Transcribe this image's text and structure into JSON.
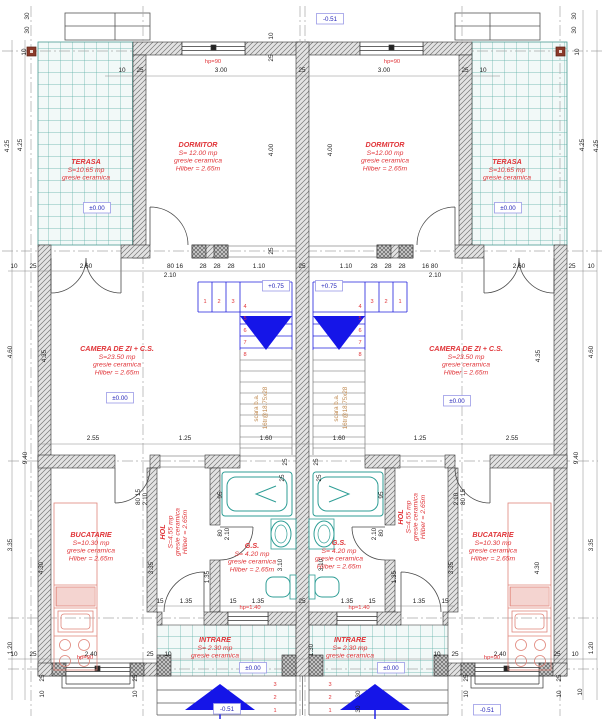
{
  "drawing": {
    "type": "architectural-floor-plan",
    "colors": {
      "room_label": "#e03438",
      "level_text": "#2626b8",
      "level_box_border": "#9a9ae6",
      "stair_blue": "#2020dd",
      "arrow_blue": "#1515e8",
      "tile_teal": "#58ada5",
      "fixture_teal": "#2f9e96",
      "stair_note_orange": "#c08a50",
      "kitchen_pink": "#e0857a",
      "wall_gray": "#6f6f6f",
      "axis_marker_red": "#8b3a2a"
    },
    "rooms": [
      {
        "id": "terasa-left",
        "name": "TERASA",
        "area": "S=10.65 mp",
        "finish": "gresie ceramica",
        "x": 86,
        "y": 164,
        "vertical": false
      },
      {
        "id": "terasa-right",
        "name": "TERASA",
        "area": "S=10.65 mp",
        "finish": "gresie ceramica",
        "x": 507,
        "y": 164,
        "vertical": false
      },
      {
        "id": "dormitor-left",
        "name": "DORMITOR",
        "area": "S= 12.00 mp",
        "finish": "gresie ceramica",
        "height": "Hliber = 2.65m",
        "x": 198,
        "y": 147,
        "vertical": false
      },
      {
        "id": "dormitor-right",
        "name": "DORMITOR",
        "area": "S=12.00 mp",
        "finish": "gresie ceramica",
        "height": "Hliber = 2.65m",
        "x": 385,
        "y": 147,
        "vertical": false
      },
      {
        "id": "camera-zi-left",
        "name": "CAMERA DE ZI + C.S.",
        "area": "S=23.50 mp",
        "finish": "gresie ceramica",
        "height": "Hliber = 2.65m",
        "x": 117,
        "y": 351,
        "vertical": false
      },
      {
        "id": "camera-zi-right",
        "name": "CAMERA DE ZI + C.S.",
        "area": "S=23.50 mp",
        "finish": "gresie ceramica",
        "height": "Hliber = 2.65m",
        "x": 466,
        "y": 351,
        "vertical": false
      },
      {
        "id": "bucatarie-left",
        "name": "BUCATARIE",
        "area": "S=10.30 mp",
        "finish": "gresie ceramica",
        "height": "Hliber = 2.65m",
        "x": 91,
        "y": 537,
        "vertical": false
      },
      {
        "id": "bucatarie-right",
        "name": "BUCATARIE",
        "area": "S=10.30 mp",
        "finish": "gresie ceramica",
        "height": "Hliber = 2.65m",
        "x": 493,
        "y": 537,
        "vertical": false
      },
      {
        "id": "hol-left",
        "name": "HOL",
        "area": "S=4.55 mp",
        "finish": "gresie ceramica",
        "height": "Hliber = 2.65m",
        "x": 176,
        "y": 532,
        "vertical": true
      },
      {
        "id": "hol-right",
        "name": "HOL",
        "area": "S=4.55 mp",
        "finish": "gresie ceramica",
        "height": "Hliber = 2.65m",
        "x": 414,
        "y": 517,
        "vertical": true
      },
      {
        "id": "gs-left",
        "name": "G.S.",
        "area": "S= 4.20 mp",
        "finish": "gresie ceramica",
        "height": "Hliber = 2.65m",
        "x": 252,
        "y": 548,
        "vertical": false
      },
      {
        "id": "gs-right",
        "name": "G.S.",
        "area": "S= 4.20 mp",
        "finish": "gresie ceramica",
        "height": "Hliber = 2.65m",
        "x": 339,
        "y": 545,
        "vertical": false
      },
      {
        "id": "intrare-left",
        "name": "INTRARE",
        "area": "S= 2.30 mp",
        "finish": "gresie ceramica",
        "x": 215,
        "y": 642,
        "vertical": false
      },
      {
        "id": "intrare-right",
        "name": "INTRARE",
        "area": "S= 2.30 mp",
        "finish": "gresie ceramica",
        "x": 350,
        "y": 642,
        "vertical": false
      }
    ],
    "levels": [
      {
        "t": "-0.51",
        "x": 330,
        "y": 21
      },
      {
        "t": "±0.00",
        "x": 97,
        "y": 210
      },
      {
        "t": "±0.00",
        "x": 508,
        "y": 210
      },
      {
        "t": "+0.75",
        "x": 276,
        "y": 288
      },
      {
        "t": "+0.75",
        "x": 329,
        "y": 288
      },
      {
        "t": "±0.00",
        "x": 120,
        "y": 400
      },
      {
        "t": "±0.00",
        "x": 457,
        "y": 403
      },
      {
        "t": "±0.00",
        "x": 253,
        "y": 670
      },
      {
        "t": "±0.00",
        "x": 391,
        "y": 670
      },
      {
        "t": "-0.51",
        "x": 227,
        "y": 711
      },
      {
        "t": "-0.51",
        "x": 487,
        "y": 712
      }
    ],
    "hp_labels": [
      {
        "t": "hp=90",
        "x": 213,
        "y": 63
      },
      {
        "t": "hp=90",
        "x": 392,
        "y": 63
      },
      {
        "t": "hp=90",
        "x": 85,
        "y": 659
      },
      {
        "t": "hp=90",
        "x": 492,
        "y": 659
      },
      {
        "t": "hp=1.40",
        "x": 250,
        "y": 609
      },
      {
        "t": "hp=1.40",
        "x": 359,
        "y": 609
      }
    ],
    "stair_notes": [
      {
        "lines": [
          "scara b.a.",
          "16tr@18.75x28"
        ],
        "x": 258,
        "y": 408
      },
      {
        "lines": [
          "scara b.a.",
          "16tr@18.75x28"
        ],
        "x": 338,
        "y": 408
      }
    ],
    "step_numbers": [
      {
        "t": "1",
        "x": 205,
        "y": 303
      },
      {
        "t": "2",
        "x": 219,
        "y": 303
      },
      {
        "t": "3",
        "x": 233,
        "y": 303
      },
      {
        "t": "4",
        "x": 245,
        "y": 308
      },
      {
        "t": "5",
        "x": 245,
        "y": 320
      },
      {
        "t": "6",
        "x": 245,
        "y": 332
      },
      {
        "t": "7",
        "x": 245,
        "y": 344
      },
      {
        "t": "8",
        "x": 245,
        "y": 356
      },
      {
        "t": "1",
        "x": 400,
        "y": 303
      },
      {
        "t": "2",
        "x": 386,
        "y": 303
      },
      {
        "t": "3",
        "x": 372,
        "y": 303
      },
      {
        "t": "4",
        "x": 360,
        "y": 308
      },
      {
        "t": "5",
        "x": 360,
        "y": 320
      },
      {
        "t": "6",
        "x": 360,
        "y": 332
      },
      {
        "t": "7",
        "x": 360,
        "y": 344
      },
      {
        "t": "8",
        "x": 360,
        "y": 356
      },
      {
        "t": "3",
        "x": 275,
        "y": 686
      },
      {
        "t": "2",
        "x": 275,
        "y": 699
      },
      {
        "t": "1",
        "x": 275,
        "y": 712
      },
      {
        "t": "3",
        "x": 330,
        "y": 686
      },
      {
        "t": "2",
        "x": 330,
        "y": 699
      },
      {
        "t": "1",
        "x": 330,
        "y": 712
      }
    ],
    "dims": [
      {
        "t": "10",
        "x": 122,
        "y": 72
      },
      {
        "t": "25",
        "x": 140,
        "y": 72
      },
      {
        "t": "3.00",
        "x": 221,
        "y": 72
      },
      {
        "t": "25",
        "x": 302,
        "y": 72
      },
      {
        "t": "3.00",
        "x": 384,
        "y": 72
      },
      {
        "t": "25",
        "x": 465,
        "y": 72
      },
      {
        "t": "10",
        "x": 483,
        "y": 72
      },
      {
        "t": "10",
        "x": 273,
        "y": 36,
        "v": 1
      },
      {
        "t": "25",
        "x": 273,
        "y": 58,
        "v": 1
      },
      {
        "t": "10",
        "x": 14,
        "y": 268
      },
      {
        "t": "25",
        "x": 33,
        "y": 268
      },
      {
        "t": "2.60",
        "x": 86,
        "y": 268
      },
      {
        "t": "80 16",
        "x": 175,
        "y": 268
      },
      {
        "t": "28",
        "x": 203,
        "y": 268
      },
      {
        "t": "28",
        "x": 217,
        "y": 268
      },
      {
        "t": "28",
        "x": 231,
        "y": 268
      },
      {
        "t": "1.10",
        "x": 259,
        "y": 268
      },
      {
        "t": "25",
        "x": 302,
        "y": 268
      },
      {
        "t": "1.10",
        "x": 346,
        "y": 268
      },
      {
        "t": "28",
        "x": 374,
        "y": 268
      },
      {
        "t": "28",
        "x": 388,
        "y": 268
      },
      {
        "t": "28",
        "x": 402,
        "y": 268
      },
      {
        "t": "16 80",
        "x": 430,
        "y": 268
      },
      {
        "t": "2.60",
        "x": 519,
        "y": 268
      },
      {
        "t": "25",
        "x": 572,
        "y": 268
      },
      {
        "t": "10",
        "x": 591,
        "y": 268
      },
      {
        "t": "2.10",
        "x": 170,
        "y": 277
      },
      {
        "t": "2.10",
        "x": 435,
        "y": 277
      },
      {
        "t": "2.55",
        "x": 93,
        "y": 440
      },
      {
        "t": "1.25",
        "x": 185,
        "y": 440
      },
      {
        "t": "1.60",
        "x": 266,
        "y": 440
      },
      {
        "t": "1.60",
        "x": 339,
        "y": 440
      },
      {
        "t": "1.25",
        "x": 420,
        "y": 440
      },
      {
        "t": "2.55",
        "x": 512,
        "y": 440
      },
      {
        "t": "25",
        "x": 287,
        "y": 462,
        "v": 1
      },
      {
        "t": "25",
        "x": 318,
        "y": 462,
        "v": 1
      },
      {
        "t": "95",
        "x": 222,
        "y": 495,
        "v": 1
      },
      {
        "t": "80",
        "x": 222,
        "y": 533,
        "v": 1
      },
      {
        "t": "2.10",
        "x": 229,
        "y": 534,
        "v": 1
      },
      {
        "t": "3.10",
        "x": 282,
        "y": 565,
        "v": 1
      },
      {
        "t": "1.35",
        "x": 209,
        "y": 577,
        "v": 1
      },
      {
        "t": "95",
        "x": 383,
        "y": 495,
        "v": 1
      },
      {
        "t": "80",
        "x": 383,
        "y": 533,
        "v": 1
      },
      {
        "t": "2.10",
        "x": 376,
        "y": 534,
        "v": 1
      },
      {
        "t": "3.10",
        "x": 323,
        "y": 565,
        "v": 1
      },
      {
        "t": "1.35",
        "x": 396,
        "y": 577,
        "v": 1
      },
      {
        "t": "80 15",
        "x": 140,
        "y": 497,
        "v": 1
      },
      {
        "t": "2.10",
        "x": 147,
        "y": 499,
        "v": 1
      },
      {
        "t": "3.35",
        "x": 153,
        "y": 568,
        "v": 1
      },
      {
        "t": "80 15",
        "x": 465,
        "y": 497,
        "v": 1
      },
      {
        "t": "2.10",
        "x": 458,
        "y": 499,
        "v": 1
      },
      {
        "t": "3.35",
        "x": 453,
        "y": 568,
        "v": 1
      },
      {
        "t": "4.30",
        "x": 43,
        "y": 568,
        "v": 1
      },
      {
        "t": "4.30",
        "x": 539,
        "y": 568,
        "v": 1
      },
      {
        "t": "15",
        "x": 160,
        "y": 603
      },
      {
        "t": "1.35",
        "x": 186,
        "y": 603
      },
      {
        "t": "15",
        "x": 233,
        "y": 603
      },
      {
        "t": "1.35",
        "x": 258,
        "y": 603
      },
      {
        "t": "25",
        "x": 302,
        "y": 603
      },
      {
        "t": "1.35",
        "x": 347,
        "y": 603
      },
      {
        "t": "15",
        "x": 372,
        "y": 603
      },
      {
        "t": "1.35",
        "x": 419,
        "y": 603
      },
      {
        "t": "15",
        "x": 445,
        "y": 603
      },
      {
        "t": "25",
        "x": 284,
        "y": 478,
        "v": 1
      },
      {
        "t": "25",
        "x": 321,
        "y": 478,
        "v": 1
      },
      {
        "t": "1.30",
        "x": 313,
        "y": 650,
        "v": 1
      },
      {
        "t": "30",
        "x": 360,
        "y": 694,
        "v": 1
      },
      {
        "t": "30",
        "x": 360,
        "y": 709,
        "v": 1
      },
      {
        "t": "10",
        "x": 14,
        "y": 656
      },
      {
        "t": "25",
        "x": 33,
        "y": 656
      },
      {
        "t": "2.40",
        "x": 91,
        "y": 656
      },
      {
        "t": "25",
        "x": 150,
        "y": 656
      },
      {
        "t": "10",
        "x": 168,
        "y": 656
      },
      {
        "t": "10",
        "x": 437,
        "y": 656
      },
      {
        "t": "25",
        "x": 455,
        "y": 656
      },
      {
        "t": "2.40",
        "x": 500,
        "y": 656
      },
      {
        "t": "25",
        "x": 557,
        "y": 656
      },
      {
        "t": "10",
        "x": 575,
        "y": 656
      },
      {
        "t": "25",
        "x": 44,
        "y": 678,
        "v": 1
      },
      {
        "t": "10",
        "x": 44,
        "y": 694,
        "v": 1
      },
      {
        "t": "25",
        "x": 137,
        "y": 678,
        "v": 1
      },
      {
        "t": "10",
        "x": 137,
        "y": 694,
        "v": 1
      },
      {
        "t": "25",
        "x": 468,
        "y": 678,
        "v": 1
      },
      {
        "t": "10",
        "x": 468,
        "y": 694,
        "v": 1
      },
      {
        "t": "25",
        "x": 561,
        "y": 678,
        "v": 1
      },
      {
        "t": "10",
        "x": 561,
        "y": 694,
        "v": 1
      },
      {
        "t": "30",
        "x": 29,
        "y": 16,
        "v": 1
      },
      {
        "t": "30",
        "x": 29,
        "y": 30,
        "v": 1
      },
      {
        "t": "10",
        "x": 26,
        "y": 52,
        "v": 1
      },
      {
        "t": "4.25",
        "x": 9,
        "y": 146,
        "v": 1
      },
      {
        "t": "4.25",
        "x": 22,
        "y": 145,
        "v": 1
      },
      {
        "t": "30",
        "x": 576,
        "y": 16,
        "v": 1
      },
      {
        "t": "30",
        "x": 576,
        "y": 30,
        "v": 1
      },
      {
        "t": "10",
        "x": 579,
        "y": 52,
        "v": 1
      },
      {
        "t": "4.25",
        "x": 584,
        "y": 145,
        "v": 1
      },
      {
        "t": "4.25",
        "x": 598,
        "y": 146,
        "v": 1
      },
      {
        "t": "4.60",
        "x": 593,
        "y": 352,
        "v": 1
      },
      {
        "t": "9.40",
        "x": 578,
        "y": 458,
        "v": 1
      },
      {
        "t": "3.35",
        "x": 593,
        "y": 545,
        "v": 1
      },
      {
        "t": "1.20",
        "x": 593,
        "y": 648,
        "v": 1
      },
      {
        "t": "10",
        "x": 582,
        "y": 692,
        "v": 1
      },
      {
        "t": "4.60",
        "x": 12,
        "y": 352,
        "v": 1
      },
      {
        "t": "9.40",
        "x": 27,
        "y": 458,
        "v": 1
      },
      {
        "t": "3.35",
        "x": 12,
        "y": 545,
        "v": 1
      },
      {
        "t": "1.20",
        "x": 12,
        "y": 648,
        "v": 1
      },
      {
        "t": "4.00",
        "x": 273,
        "y": 150,
        "v": 1
      },
      {
        "t": "4.00",
        "x": 332,
        "y": 150,
        "v": 1
      },
      {
        "t": "4.35",
        "x": 46,
        "y": 356,
        "v": 1
      },
      {
        "t": "4.35",
        "x": 540,
        "y": 356,
        "v": 1
      },
      {
        "t": "25",
        "x": 273,
        "y": 251,
        "v": 1
      }
    ],
    "axis_markers": [
      {
        "x": 27,
        "y": 47
      },
      {
        "x": 556,
        "y": 47
      }
    ]
  }
}
